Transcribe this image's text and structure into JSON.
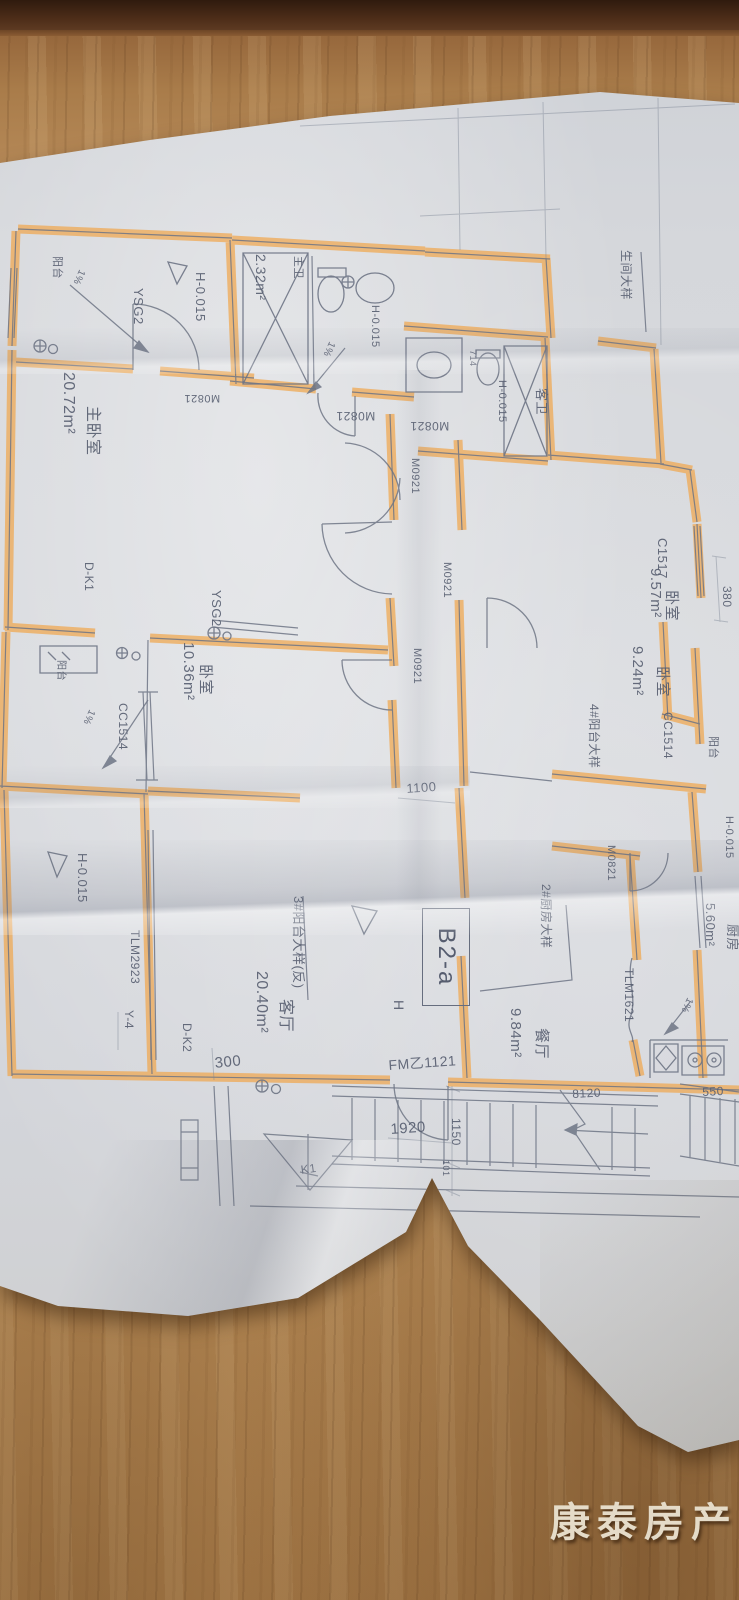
{
  "watermark": {
    "text": "康泰房产"
  },
  "plan_labels": {
    "balcony_tl": "阳台",
    "slope_tl": "1%",
    "ysg2_tl": "YSG2",
    "h0015_tl": "H-0.015",
    "zhuwei": "主卫",
    "zhuwei_area": "2.32m²",
    "zhuwei_h": "H-0.015",
    "zhuwei_slope": "1%",
    "zhuwei_door": "M0821",
    "kewei_door": "M0821",
    "kewei": "客卫",
    "kewei_h": "H-0.015",
    "dim_714": "714",
    "detail_bath": "生间大样",
    "master_bedroom": "主卧室",
    "master_area": "20.72m²",
    "master_door": "M0821",
    "door_m0921_a": "M0921",
    "door_m0921_b": "M0921",
    "door_m0921_c": "M0921",
    "win_c1517": "C1517",
    "bedroom_e": "卧室",
    "bedroom_e_area": "9.57m²",
    "dim_380": "380",
    "bedroom_se": "卧室",
    "bedroom_se_area": "9.24m²",
    "win_cc1514_e": "CC1514",
    "detail_balcony4": "4#阳台大样",
    "balcony_e": "阳台",
    "dk1": "D-K1",
    "ysg2_mid": "YSG2",
    "bedroom_w": "卧室",
    "bedroom_w_area": "10.36m²",
    "win_cc1514_w": "CC1514",
    "balcony_w": "阳台",
    "slope_w": "1%",
    "h0015_w": "H-0.015",
    "detail_balcony3": "3#阳台大样(反)",
    "living_room": "客厅",
    "living_area": "20.40m²",
    "tlm2923": "TLM2923",
    "y4": "Y-4",
    "dk2": "D-K2",
    "dim_300": "300",
    "h_mark": "H",
    "unit_code": "B2-a",
    "detail_kitchen2": "2#厨房大样",
    "dining": "餐厅",
    "dining_area": "9.84m²",
    "fm1121": "FM乙1121",
    "dim_1920": "1920",
    "dim_1150": "1150",
    "dim_101": "101",
    "dim_8120": "8120",
    "dim_550": "550",
    "k1": "K1",
    "tlm1621": "TLM1621",
    "kitchen": "厨房",
    "kitchen_area": "5.60m²",
    "kitchen_slope": "1%",
    "h0015_e": "H-0.015",
    "kitchen_door": "M0821",
    "dim_1100": "1100"
  }
}
